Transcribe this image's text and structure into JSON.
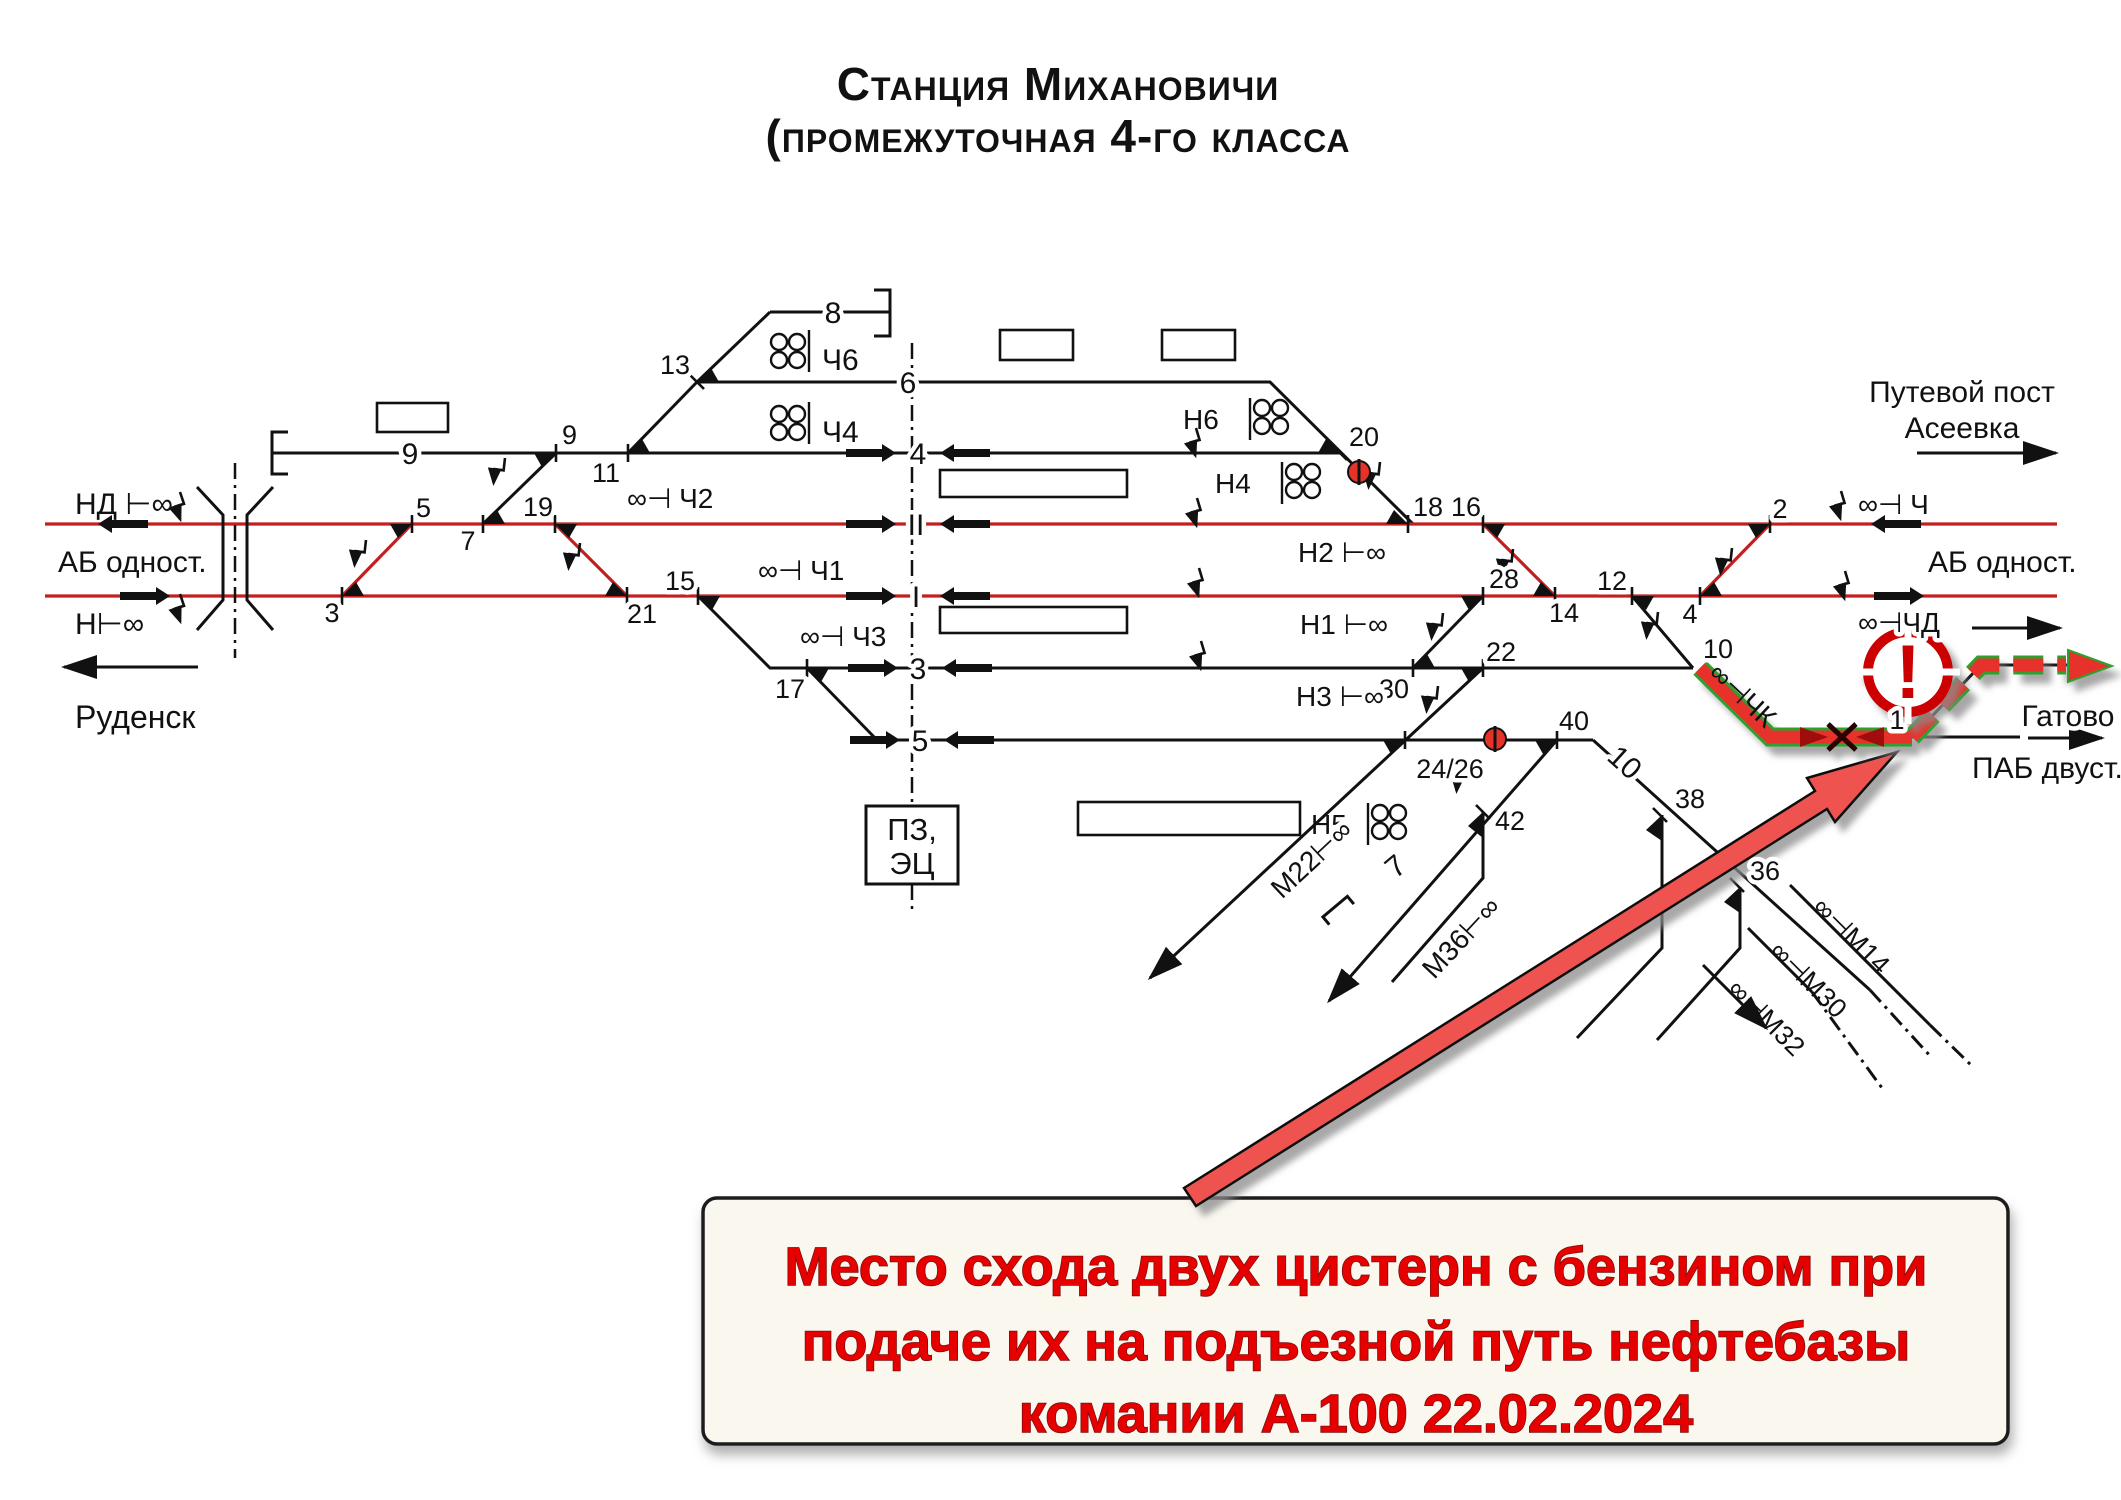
{
  "title": {
    "line1": "Станция Михановичи",
    "line2": "(промежуточная 4-го класса"
  },
  "left": {
    "signal_nd": "НД ⊢∞",
    "ab": "АБ одност.",
    "signal_n": "Н⊢∞",
    "dest": "Руденск"
  },
  "right": {
    "post1": "Путевой пост",
    "post2": "Асеевка",
    "signal_ch": "∞⊣ Ч",
    "ab": "АБ одност.",
    "signal_chd": "∞⊣ЧД",
    "dest": "Гатово",
    "pab": "ПАБ двуст."
  },
  "box": {
    "line1": "ПЗ,",
    "line2": "ЭЦ"
  },
  "tracks": {
    "t8": "8",
    "t9": "9",
    "t6": "6",
    "t4": "4",
    "t2": "II",
    "t1": "I",
    "t3": "3",
    "t5": "5"
  },
  "switches": {
    "s3": "3",
    "s5": "5",
    "s7": "7",
    "s9": "9",
    "s11": "11",
    "s13": "13",
    "s15": "15",
    "s17": "17",
    "s19": "19",
    "s21": "21",
    "s20": "20",
    "s18": "18",
    "s16": "16",
    "s28": "28",
    "s14": "14",
    "s12": "12",
    "s4": "4",
    "s2": "2",
    "s30": "30",
    "s22": "22",
    "s2426": "24/26",
    "s40": "40",
    "s10": "10",
    "s1": "1",
    "s42": "42",
    "s38": "38",
    "s36": "36",
    "b10": "10",
    "b7": "7"
  },
  "signals": {
    "ch6": "Ч6",
    "ch4": "Ч4",
    "ch2": "∞⊣ Ч2",
    "ch1": "∞⊣ Ч1",
    "ch3": "∞⊣ Ч3",
    "n6": "Н6",
    "n4": "Н4",
    "n2": "Н2 ⊢∞",
    "n1": "Н1 ⊢∞",
    "n3": "Н3 ⊢∞",
    "n5": "Н5",
    "m22": "М22⊢∞",
    "m36": "М36⊢∞",
    "chk": "∞⊣ЧК",
    "m14": "∞⊣М14",
    "m30": "∞⊣М30",
    "m32": "∞⊣М32"
  },
  "warning": {
    "mark": "!"
  },
  "annotation": {
    "line1": "Место схода двух цистерн с бензином при",
    "line2": "подаче их на подъезной путь нефтебазы",
    "line3": "комании А-100 22.02.2024"
  },
  "colors": {
    "track_main": "#c41f1f",
    "route": "#e63329",
    "route_edge": "#2fa02f",
    "arrow": "#ef5350",
    "warning": "#cc0000",
    "annotation_text": "#e60000",
    "annotation_bg": "#faf7ee"
  }
}
